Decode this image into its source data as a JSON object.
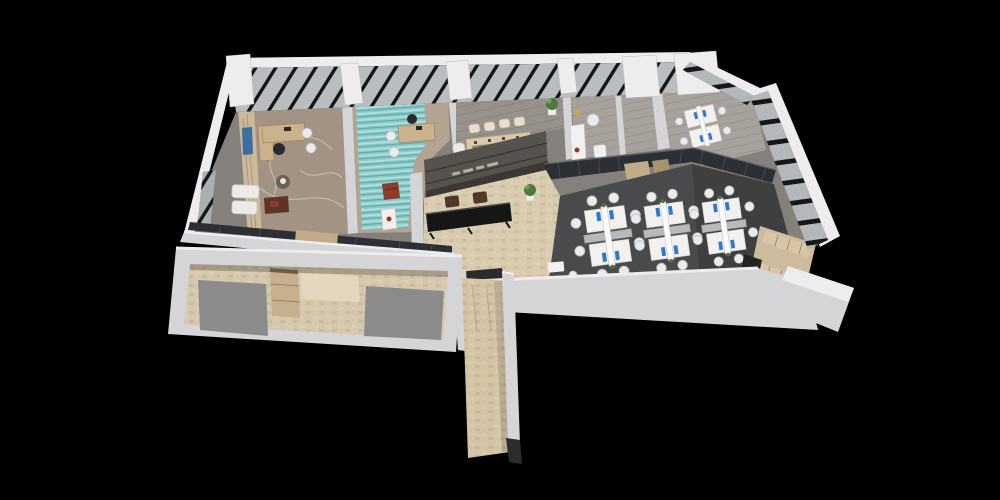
{
  "scene": {
    "type": "3d-isometric-floor-plan-render",
    "description": "Cutaway top-down 3D render of an office floor with executive office, lounge office with teal rug, meeting room, pantry, corner team office, reception with black counter, open-plan office with three workstation clusters, locker/storage room, detached service block and elevator corridor, on a black background",
    "background": "#000000"
  },
  "colors": {
    "background": "#000000",
    "wallTop": "#ededef",
    "wallFace": "#d5d5d8",
    "wallShade": "#aaaaae",
    "interiorBase": "#84807b",
    "windowBand": "#1d1e20",
    "glassPane": "#cfd3d6",
    "mullion": "#141517",
    "execFloor": "#a39384",
    "execSwirl": "#d2c3b0",
    "shelfWood": "#cbb999",
    "artBlue": "#3a6ea5",
    "tealRug": "#89ccc9",
    "tealLight": "#dff0ee",
    "woodFloor": "#b3a392",
    "grayPlank": "#96918b",
    "grayPlankLight": "#a7a29c",
    "tableBeige": "#d9c8a9",
    "chairBeige": "#e6dfcf",
    "stoneBeige": "#d8cbae",
    "featureWall": "#56524d",
    "featureWallDark": "#3b3834",
    "signLight": "#b9af9f",
    "counterBlack": "#161616",
    "chairBrown": "#50392a",
    "darkFloor": "#4a4a4c",
    "deskWhite": "#f2f1ef",
    "chairWhite": "#e9ebec",
    "chairStroke": "#b5b8ba",
    "monitorBlue": "#2e77cf",
    "glassDark": "#2c2f33",
    "glassLight": "#4a5055",
    "doorWood": "#c2ab87",
    "doorWoodDark": "#a8926f",
    "lockerFloor": "#cdbb9d",
    "lockerWood": "#d8c5a5",
    "annexBeige": "#d5c8ac",
    "annexBright": "#e3d8bf",
    "annexGray": "#8b8b8c",
    "cabinetWood": "#c6b08d",
    "corridorBeige": "#d3c4a6",
    "elevatorDark": "#2b2b2e",
    "blackCap": "#2c2c2f",
    "plantGreen": "#4e7a3a",
    "plantPot": "#f0eee9",
    "accentRed": "#8e3b2c",
    "accentYellow": "#d9a23c",
    "deskWood": "#c9b28c",
    "blackChair": "#2b2b2d",
    "poufBrown": "#6b6156",
    "cabinetGray": "#b9b9bb",
    "sofaWhite": "#eceae6",
    "tableDarkRed": "#5f3327"
  },
  "rooms": [
    {
      "id": "executive-office",
      "label": "Executive office"
    },
    {
      "id": "lounge-office",
      "label": "Office with teal rug"
    },
    {
      "id": "meeting-room",
      "label": "Meeting room"
    },
    {
      "id": "pantry",
      "label": "Pantry / tea room"
    },
    {
      "id": "corner-office",
      "label": "Corner team office"
    },
    {
      "id": "reception",
      "label": "Reception lobby"
    },
    {
      "id": "open-office",
      "label": "Open-plan office"
    },
    {
      "id": "locker-room",
      "label": "Storage / locker room"
    },
    {
      "id": "service-block",
      "label": "Detached service block"
    },
    {
      "id": "elevator-corridor",
      "label": "Elevator corridor"
    }
  ],
  "counts": {
    "open_office_clusters": 3,
    "desks_per_cluster": 4,
    "corner_office_desks": 4,
    "meeting_chairs": 9,
    "reception_guest_chairs": 2
  }
}
